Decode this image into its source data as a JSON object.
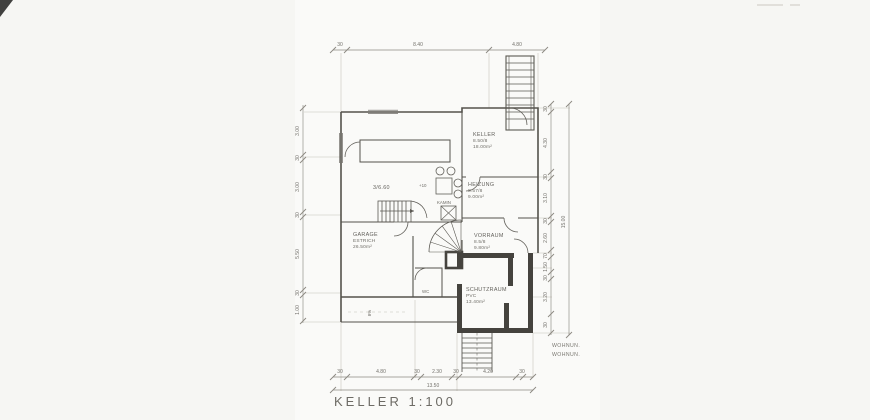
{
  "meta": {
    "drawing_title": "KELLER 1:100"
  },
  "colors": {
    "paper": "#fafaf8",
    "ink": "#54524c",
    "light_ink": "#8d8a82",
    "thick_wall": "#45433e"
  },
  "rooms": {
    "keller": {
      "name": "KELLER",
      "sub": "8.50/8",
      "area": "18.00m²"
    },
    "heizung": {
      "name": "HEIZUNG",
      "sub": "8.57/8",
      "area": "9.00m²"
    },
    "vorraum": {
      "name": "VORRAUM",
      "sub": "8.5/8",
      "area": "9.80m²"
    },
    "schutzraum": {
      "name": "SCHUTZRAUM",
      "sub": "PVC",
      "area": "13.40m²"
    },
    "garage": {
      "name": "GARAGE",
      "sub": "ESTRICH",
      "area": "26.50m²"
    },
    "hobby": {
      "name": "3/6.60"
    },
    "wc": {
      "name": "WC"
    },
    "kamin": {
      "name": "KAMIN"
    }
  },
  "annotations": {
    "level_mark": "+10",
    "ramp_slope": "8%",
    "note_line1": "WOHNUN.",
    "note_line2": "WOHNUN."
  },
  "dims": {
    "top": [
      "30",
      "8.40",
      "4.80"
    ],
    "bottom": [
      "30",
      "4.80",
      "30",
      "2.30",
      "30",
      "4.20",
      "30"
    ],
    "bottom_total": "13.50",
    "left": [
      "3.00",
      "30",
      "3.00",
      "30",
      "5.50",
      "30",
      "1.00"
    ],
    "right": [
      "30",
      "4.30",
      "30",
      "3.10",
      "30",
      "2.60",
      "70",
      "1.50",
      "30",
      "3.20",
      "30"
    ],
    "right_total": "15.00"
  }
}
